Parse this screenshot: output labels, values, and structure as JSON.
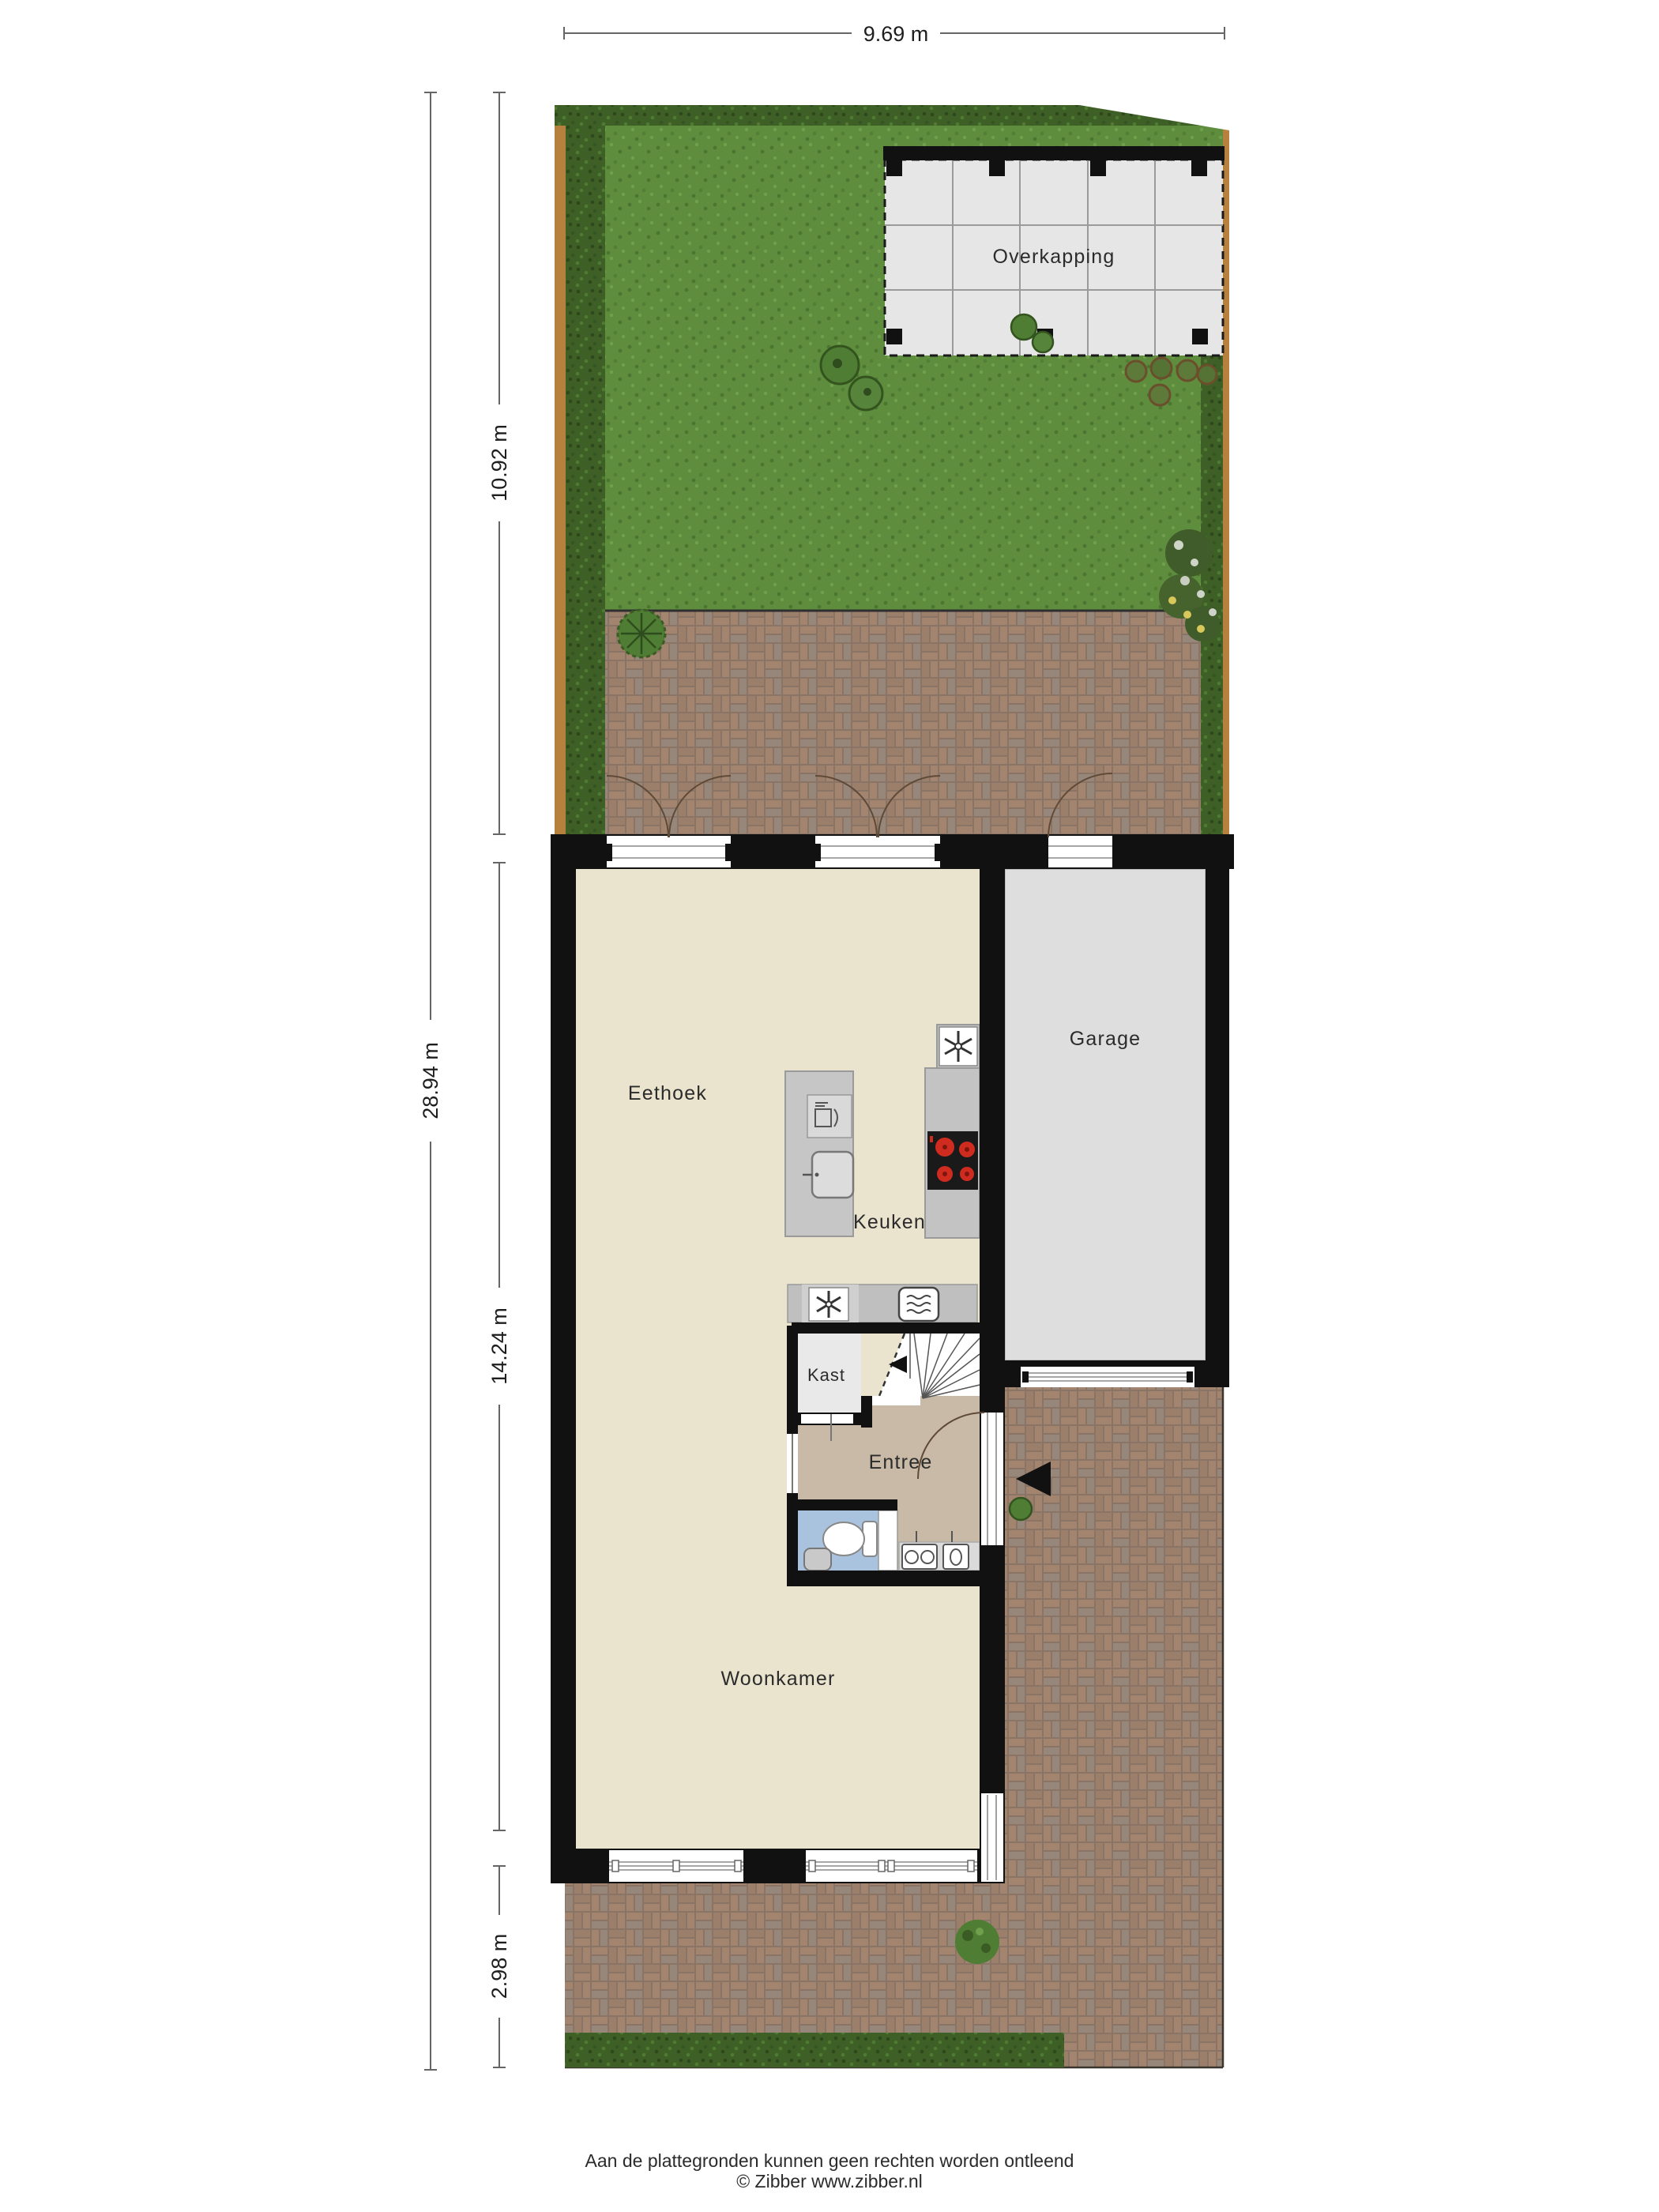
{
  "title": "Begane grond plattegrond met tuin",
  "dimensions": {
    "plot_width": "9.69 m",
    "plot_height": "28.94 m",
    "garden_depth": "10.92 m",
    "house_depth": "14.24 m",
    "front_yard_depth": "2.98 m"
  },
  "rooms": {
    "overkapping": "Overkapping",
    "eethoek": "Eethoek",
    "keuken": "Keuken",
    "garage": "Garage",
    "kast": "Kast",
    "entree": "Entree",
    "woonkamer": "Woonkamer"
  },
  "footer": {
    "disclaimer": "Aan de plattegronden kunnen geen rechten worden ontleend",
    "copyright": "© Zibber www.zibber.nl"
  },
  "icons": {
    "extractor-fan-icon": "✳",
    "microwave-icon": "▤",
    "dishwasher-icon": "▢",
    "sink-icon": "▣",
    "cooktop-icon": "●",
    "toilet-icon": "◯",
    "washbasin-icon": "▢",
    "washing-machine-icon": "◎",
    "entrance-arrow-icon": "◀",
    "stairs-icon": "≣"
  },
  "colors": {
    "wall": "#111111",
    "interior": "#eae4cf",
    "entree_floor": "#c9baa7",
    "toilet_floor": "#a9c2dd",
    "kast_floor": "#e9e9e9",
    "garage_floor": "#dedede",
    "overkapping_floor": "#e6e6e6",
    "counter_gray": "#c3c3c3",
    "lawn_green": "#5e8d3e",
    "hedge_green": "#3e6026",
    "fence_brown": "#b5813d",
    "brick_brown": "#8a7466",
    "burner_red": "#cf2b1e",
    "dimension_line": "#666666"
  }
}
